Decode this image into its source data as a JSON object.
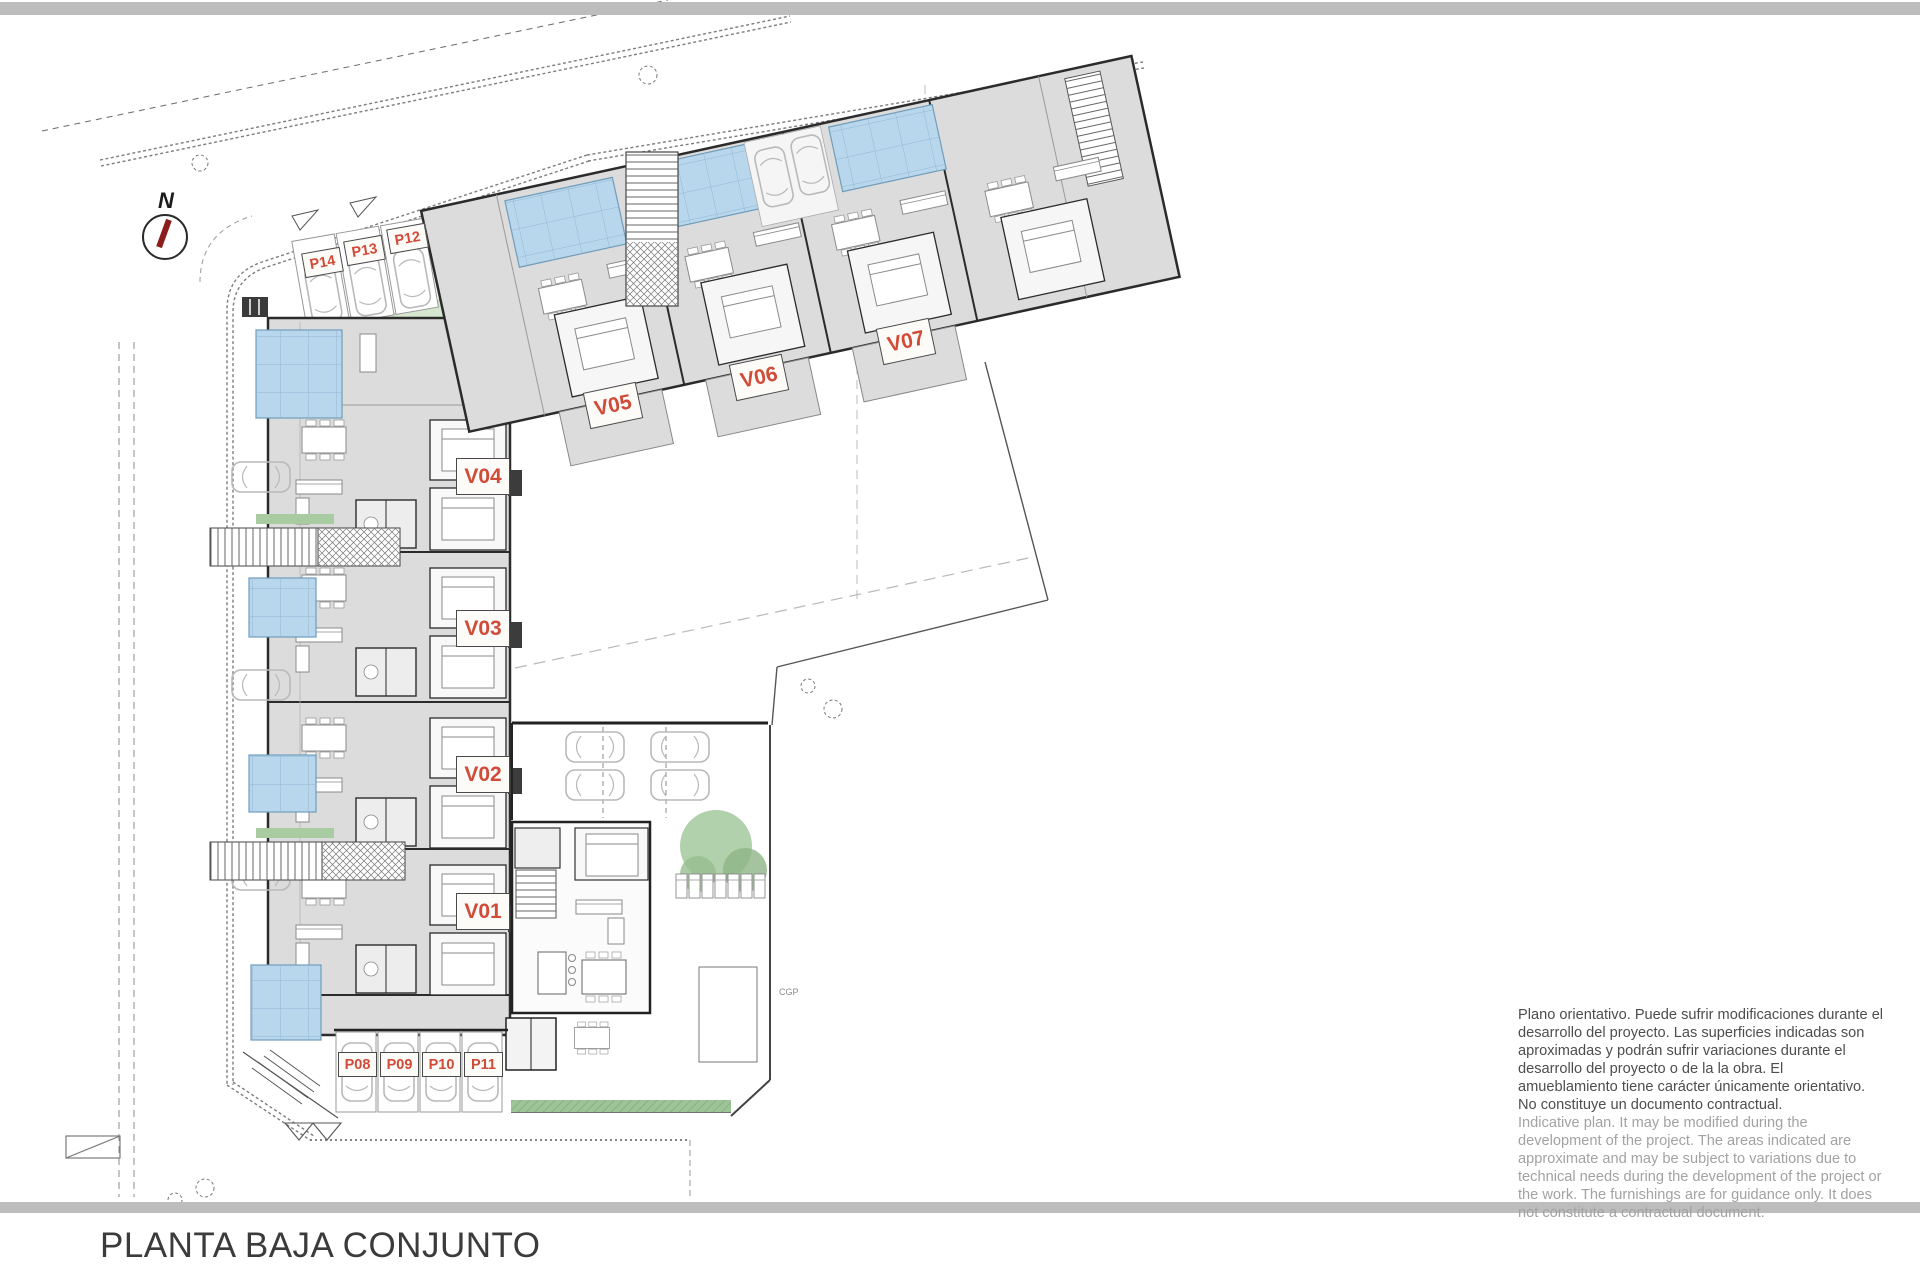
{
  "page": {
    "title": "PLANTA BAJA CONJUNTO"
  },
  "north_arrow": {
    "label": "N"
  },
  "labels": {
    "units": [
      {
        "text": "V01"
      },
      {
        "text": "V02"
      },
      {
        "text": "V03"
      },
      {
        "text": "V04"
      },
      {
        "text": "V05"
      },
      {
        "text": "V06"
      },
      {
        "text": "V07"
      }
    ],
    "parking": [
      {
        "text": "P08"
      },
      {
        "text": "P09"
      },
      {
        "text": "P10"
      },
      {
        "text": "P11"
      },
      {
        "text": "P12"
      },
      {
        "text": "P13"
      },
      {
        "text": "P14"
      }
    ]
  },
  "plan": {
    "utility_label": "CGP"
  },
  "disclaimer": {
    "es": "Plano orientativo. Puede sufrir modificaciones durante el desarrollo del proyecto. Las superficies indicadas son aproximadas y podrán sufrir variaciones durante el desarrollo del proyecto o de la la obra. El amueblamiento tiene carácter únicamente orientativo. No constituye un documento contractual.",
    "en": "Indicative plan. It may be modified during the development of the project. The areas indicated are approximate and may be subject to variations due to technical needs during the development of the project or the work. The furnishings are for guidance only. It does not constitute a contractual document."
  },
  "colors": {
    "label_red": "#d14b38",
    "pool_blue": "#b9d7ec",
    "building_gray": "#dcdcdc",
    "wall_dark": "#2b2b2b",
    "green": "#9cc496",
    "bar_gray": "#bdbdbd",
    "needle_red": "#8d1d1d"
  }
}
